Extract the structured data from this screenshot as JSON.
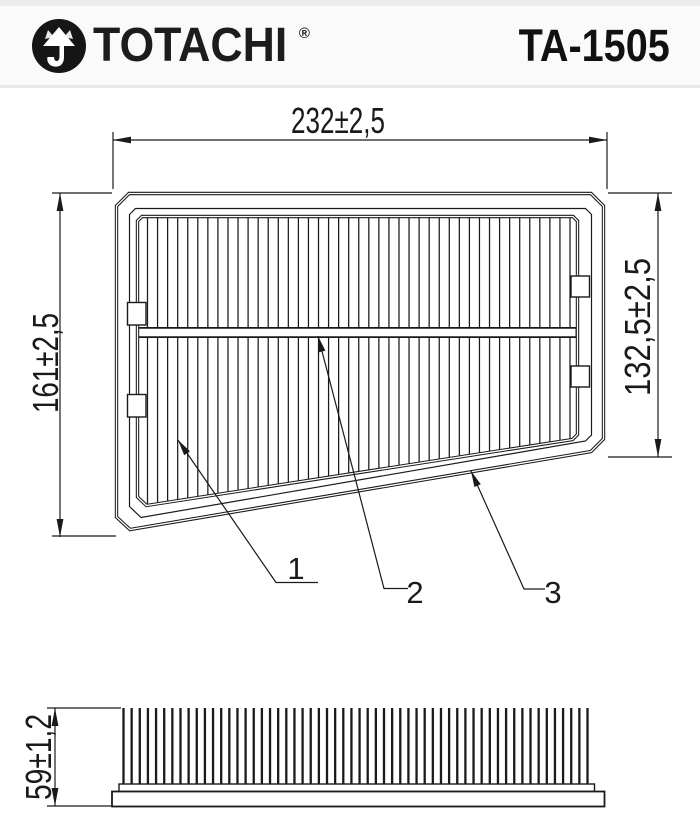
{
  "header": {
    "brand": "TOTACHI",
    "trademark": "®",
    "part_number": "TA-1505",
    "emblem_icon": "totachi-arrow-emblem",
    "background_color": "#fafafa",
    "text_color": "#1a1a1a"
  },
  "drawing": {
    "line_color": "#1a1a1a",
    "top_view": {
      "description": "air filter panel, plan view with pleats and center crossbar",
      "dim_width": "232±2,5",
      "dim_left": "161±2,5",
      "dim_right": "132,5±2,5",
      "callouts": [
        "1",
        "2",
        "3"
      ],
      "pleat_count": 43
    },
    "side_view": {
      "description": "air filter panel, side elevation with pleat teeth on base tray",
      "dim_height": "59±1,2",
      "tooth_count": 58
    }
  }
}
